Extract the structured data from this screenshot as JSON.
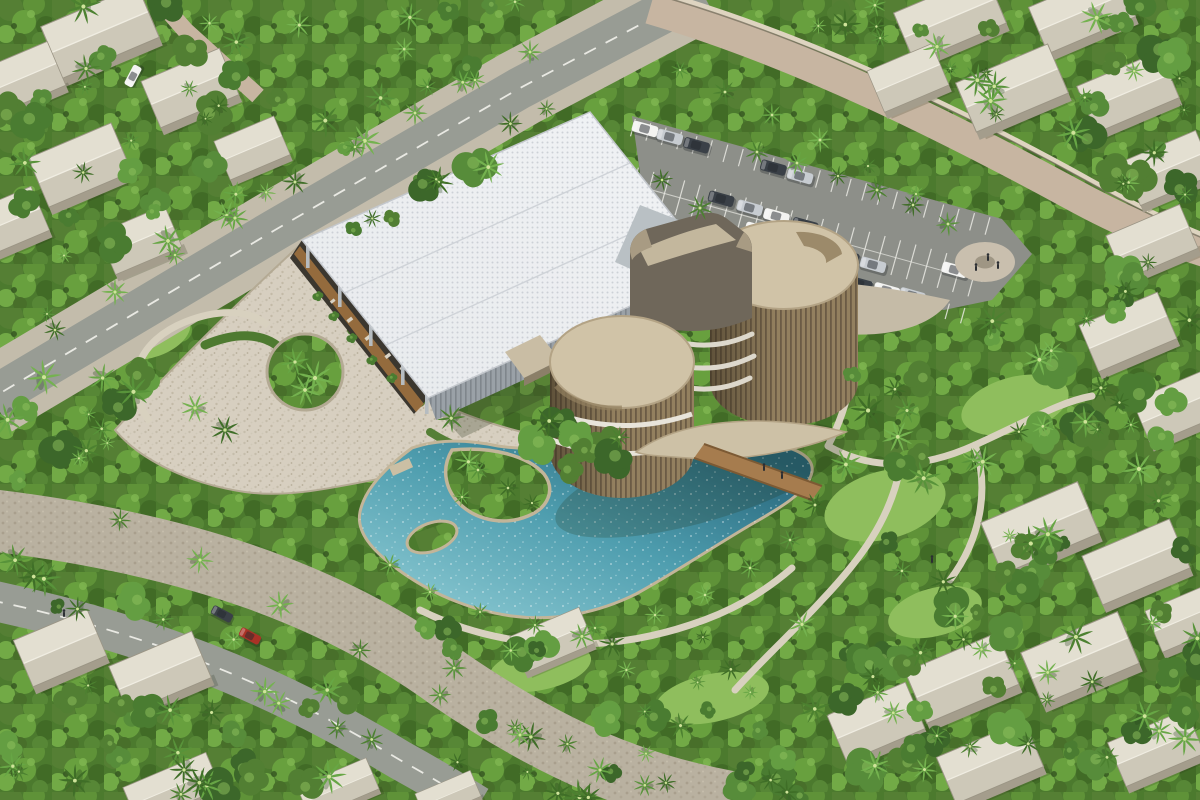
{
  "scene": {
    "kind": "aerial-architectural-rendering",
    "time_of_day": "day"
  },
  "palette": {
    "canopy_base": "#4c7a2e",
    "lawn": "#8fbe5d",
    "road_asphalt": "#989c94",
    "parking_asphalt": "#8d8f89",
    "road_marking": "#e9e9e3",
    "sidewalk": "#c3bcab",
    "promenade": "#b9b1a0",
    "stone_road": "#c7b5a1",
    "stone_wall": "#ded4c0",
    "plaza": "#d7cfc0",
    "plaza_edge": "#b4aa94",
    "path_light": "#d8d1bf",
    "roof_white": "#eef0f2",
    "roof_dot": "#c7cbd1",
    "hall_wall": "#9aa1a7",
    "tower_top": "#d0c3a7",
    "tower_slat": "#93805f",
    "tower_slat_line": "#6b5b45",
    "sail_face": "#6f675a",
    "sail_top": "#c3b79d",
    "canopy_wing": "#cdc1a6",
    "wood": "#a67c4e",
    "water_light": "#86c5cf",
    "water_mid": "#4e9dae",
    "water_deep": "#27657a",
    "pool_rim": "#c2b599",
    "house_roof_light": "#e3dfd1",
    "house_roof_shade": "#cdc8b8",
    "house_wall": "#a49d8c",
    "car_white": "#f3f3f1",
    "car_silver": "#c7ccd1",
    "car_dark": "#3a4047",
    "car_red": "#a93226",
    "person": "#2b2e32",
    "palm_greens": [
      "#3f6e27",
      "#4c8130",
      "#58933a",
      "#67a645",
      "#74b24f"
    ],
    "bush_greens": [
      "#3c672a",
      "#4a7c31",
      "#578c3a",
      "#649e42",
      "#527f33"
    ]
  },
  "counts": {
    "parking_cars": 18,
    "road_cars": 3,
    "people": 7
  }
}
